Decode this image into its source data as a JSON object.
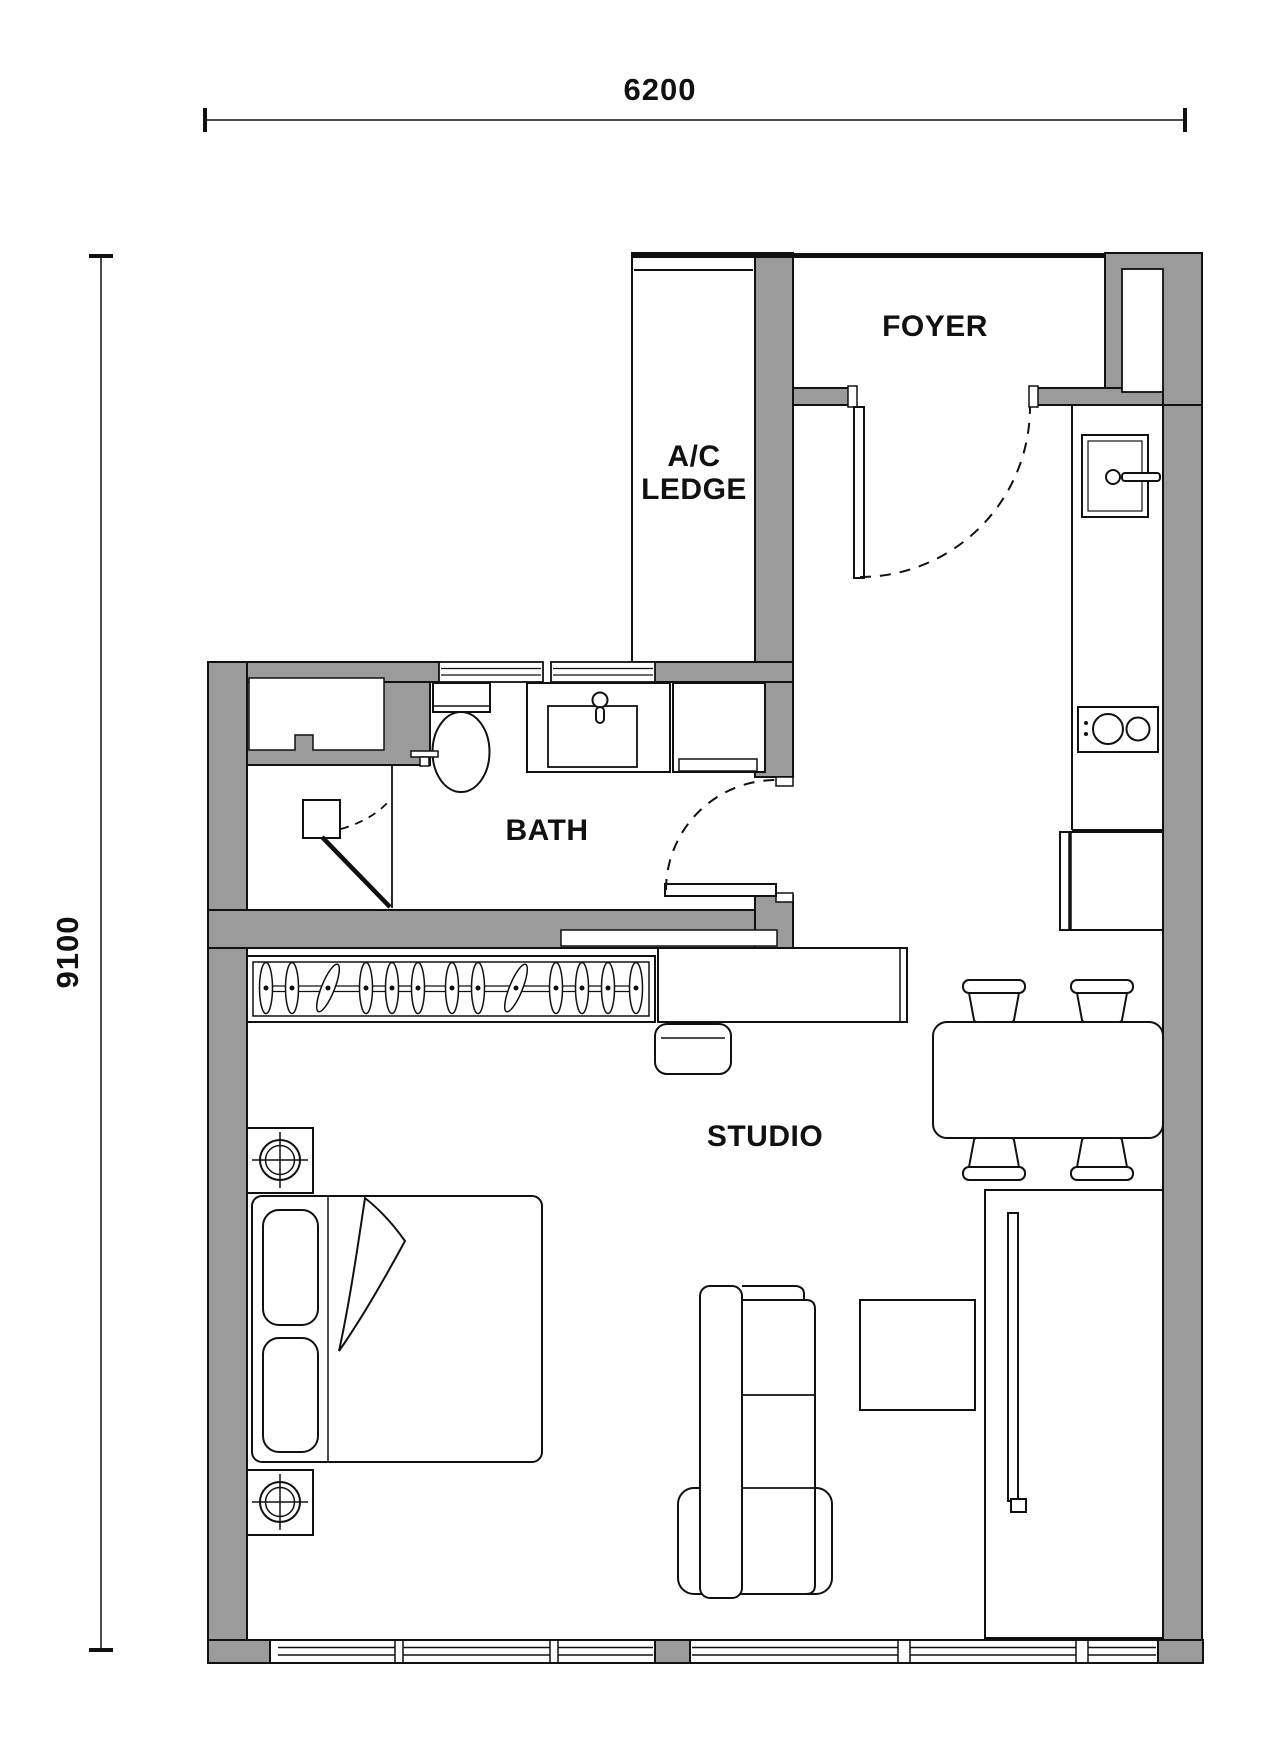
{
  "labels": {
    "foyer": "FOYER",
    "ac_ledge_line1": "A/C",
    "ac_ledge_line2": "LEDGE",
    "bath": "BATH",
    "studio": "STUDIO"
  },
  "dimensions": {
    "top": "6200",
    "left": "9100"
  },
  "colors": {
    "wall": "#9b9b9b",
    "line": "#111111",
    "bg": "#ffffff"
  },
  "furniture_icons": [
    "bed",
    "pillow",
    "blanket-fold",
    "bedside-table-lamp",
    "wardrobe-hangers",
    "desk",
    "desk-chair",
    "sofa",
    "coffee-table",
    "tv-console",
    "tv",
    "dining-table",
    "dining-chair",
    "fridge",
    "cooktop",
    "kitchen-sink",
    "faucet",
    "toilet",
    "vanity-sink",
    "shower-head",
    "shower-door",
    "door-swing",
    "window"
  ]
}
